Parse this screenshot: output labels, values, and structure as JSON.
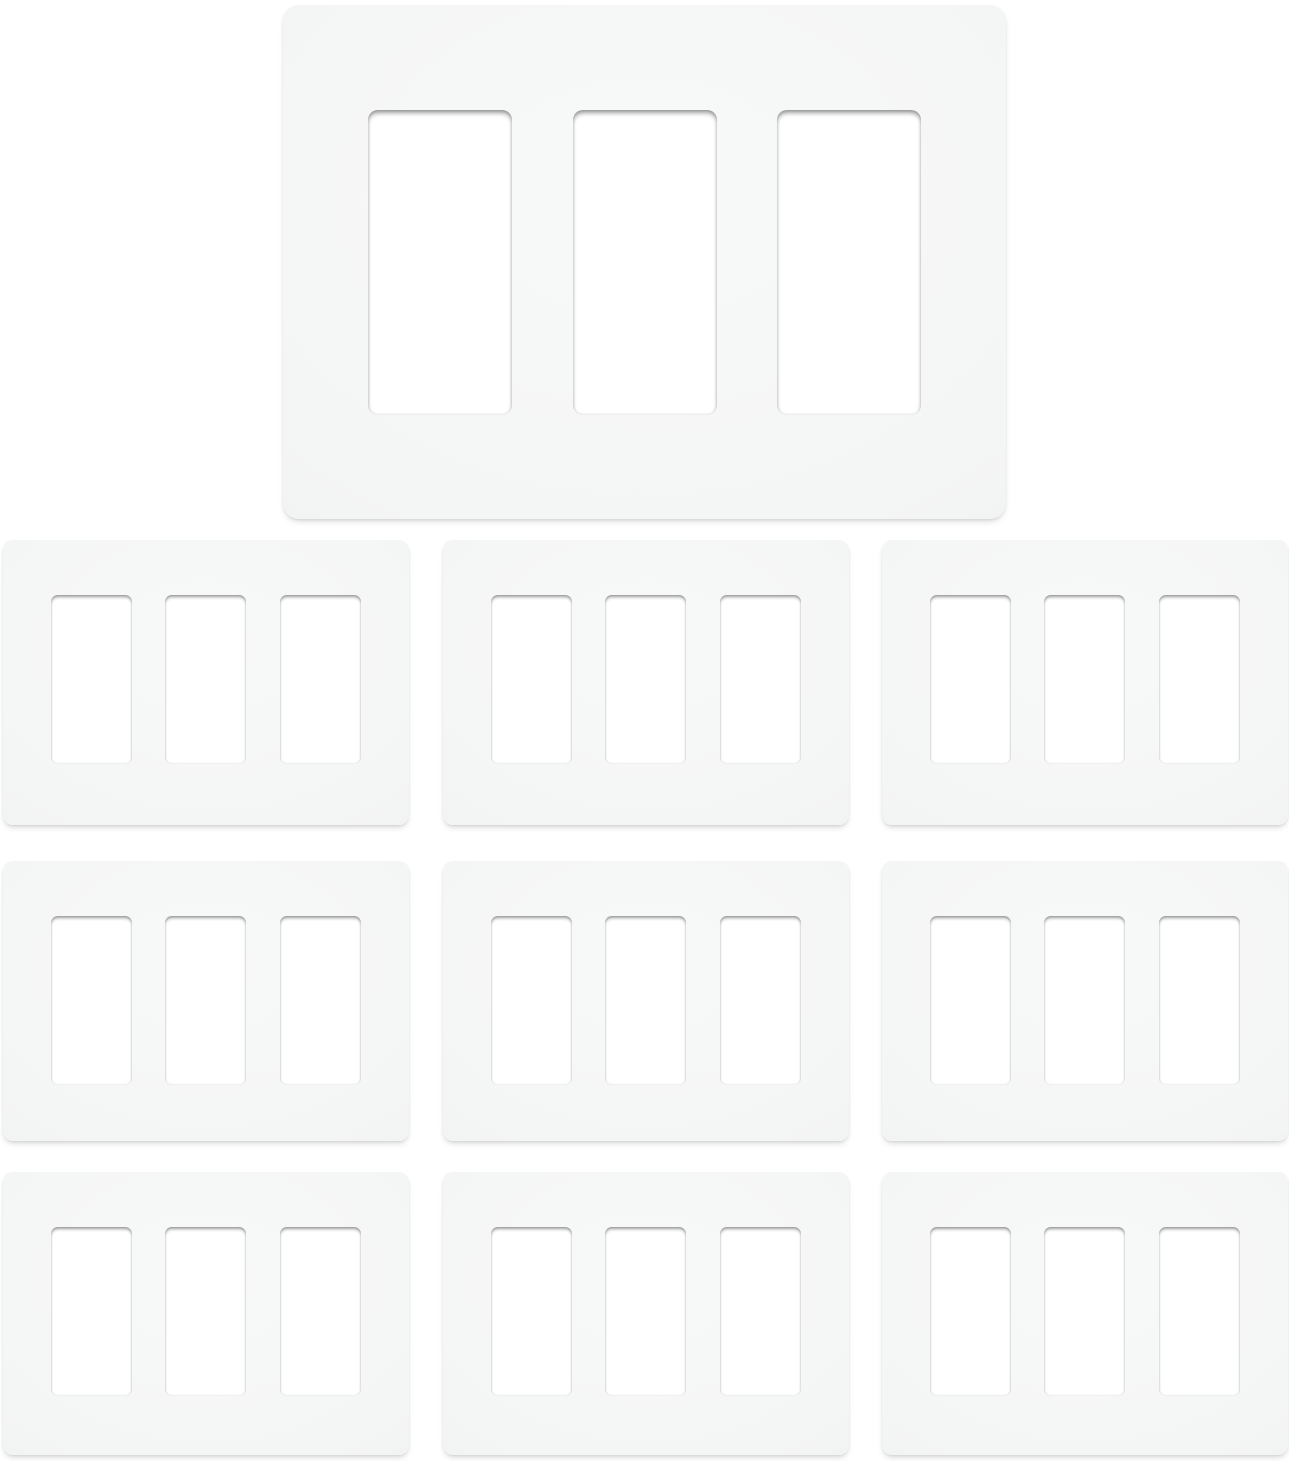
{
  "photo": {
    "description": "Product photo of ten white three-gang screwless decorator wall plates on a white background",
    "plate_count": 10,
    "openings_per_plate": 3,
    "arrangement": {
      "hero": "one large wall plate centered at top",
      "grid": "nine smaller wall plates in three rows of three"
    }
  },
  "colors": {
    "background": "#ffffff",
    "plate_light": "#f8f9f9",
    "plate_base": "#f4f5f5",
    "plate_edge": "#ebecec",
    "cutout_fill": "#ffffff"
  }
}
